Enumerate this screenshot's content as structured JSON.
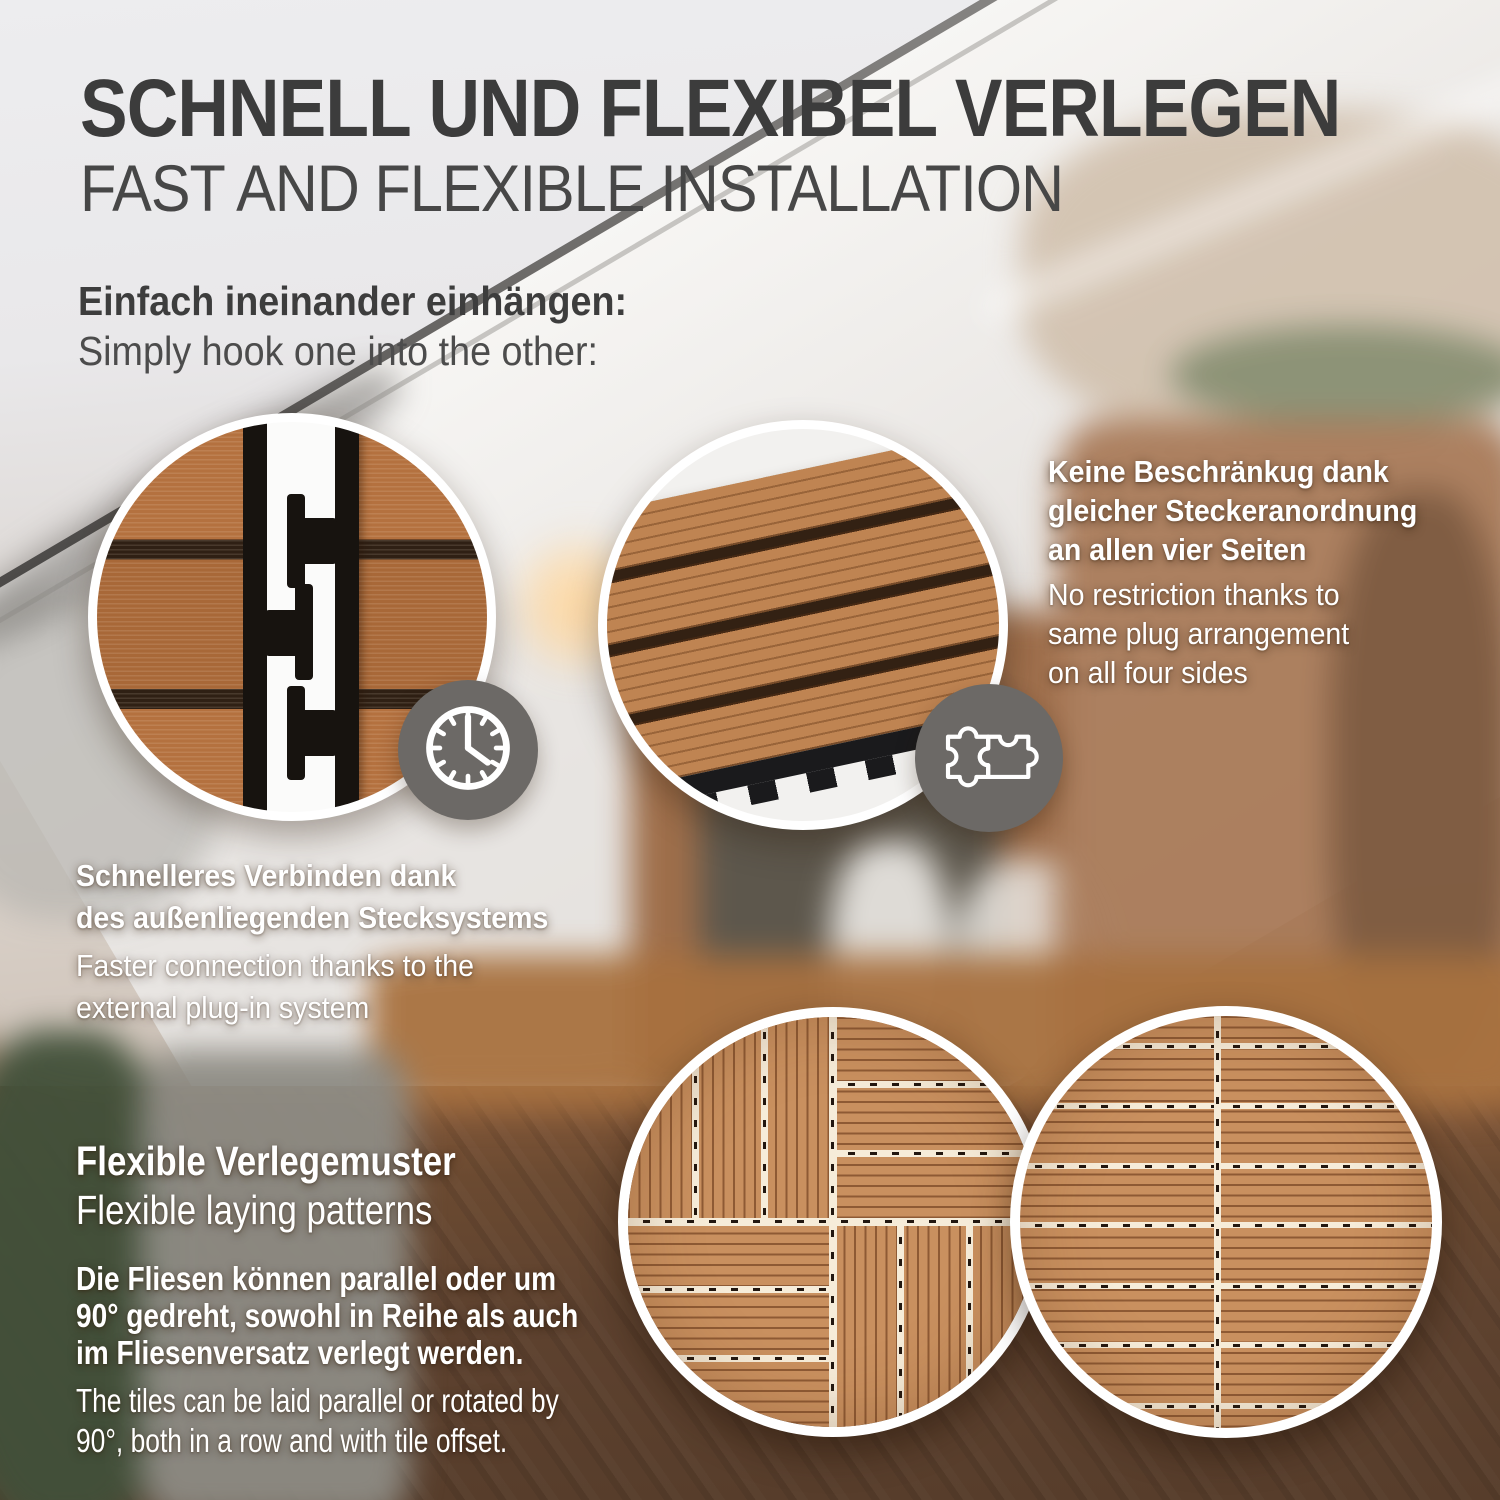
{
  "header": {
    "title": "SCHNELL UND FLEXIBEL VERLEGEN",
    "subtitle": "FAST AND FLEXIBLE INSTALLATION"
  },
  "hook_intro": {
    "heading_de": "Einfach ineinander einhängen:",
    "text_en": "Simply hook one into the other:"
  },
  "plug_callout": {
    "bold_lines": [
      "Keine Beschränkug dank",
      "gleicher Steckeranordnung",
      "an allen vier Seiten"
    ],
    "regular_lines": [
      "No restriction thanks to",
      "same plug arrangement",
      "on all four sides"
    ]
  },
  "speed_callout": {
    "bold_lines": [
      "Schnelleres Verbinden dank",
      "des außenliegenden Stecksystems"
    ],
    "regular_lines": [
      "Faster connection thanks to the",
      "external plug-in system"
    ]
  },
  "patterns_section": {
    "heading_de": "Flexible Verlegemuster",
    "heading_en": "Flexible laying patterns",
    "body_de_lines": [
      "Die Fliesen können parallel oder um",
      "90° gedreht, sowohl in Reihe als auch",
      "im Fliesenversatz verlegt werden."
    ],
    "body_en_lines": [
      "The tiles can be laid parallel or rotated by",
      "90°, both in a row and with tile offset."
    ]
  },
  "icons": {
    "clock": "clock-icon",
    "puzzle": "puzzle-icon"
  },
  "colors": {
    "heading_dark": "#3c3c3c",
    "subheading_gray": "#474747",
    "text_white": "#ffffff",
    "icon_circle_gray": "#6c6966",
    "ring_white": "#ffffff",
    "tile_light_brown": "#c9905f",
    "tile_groove_brown": "#7a4826",
    "seam_cream": "#f6ecd9",
    "clip_black": "#17130f",
    "wood_detail_brown": "#b4713f",
    "floor_dark_brown": "#5d4130"
  }
}
